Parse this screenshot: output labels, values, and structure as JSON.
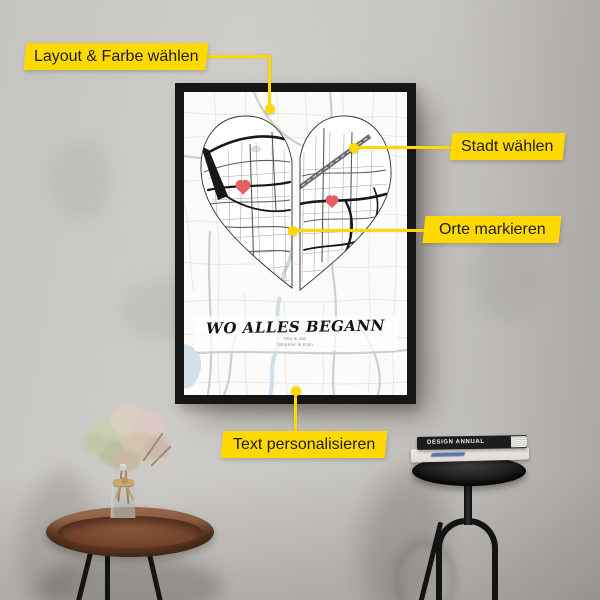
{
  "callouts": {
    "layout_farbe": {
      "label": "Layout & Farbe wählen"
    },
    "stadt": {
      "label": "Stadt wählen"
    },
    "orte": {
      "label": "Orte markieren"
    },
    "text_pers": {
      "label": "Text personalisieren"
    }
  },
  "poster": {
    "title": "WO ALLES BEGANN",
    "subtitle_line1": "Mia & Jan",
    "subtitle_line2": "Münster & Köln",
    "marker_icons": [
      "heart-marker-left",
      "heart-marker-right"
    ],
    "point_icons": [
      "map-point-top",
      "map-point-right",
      "map-point-center",
      "map-point-bottom"
    ]
  },
  "props": {
    "book_top_spine": "DESIGN ANNUAL"
  },
  "colors": {
    "accent_yellow": "#FFD900",
    "marker_red": "#E4605F",
    "frame_black": "#161616",
    "wall_gray": "#C6C4C0",
    "water_blue": "#D3E0EA"
  }
}
